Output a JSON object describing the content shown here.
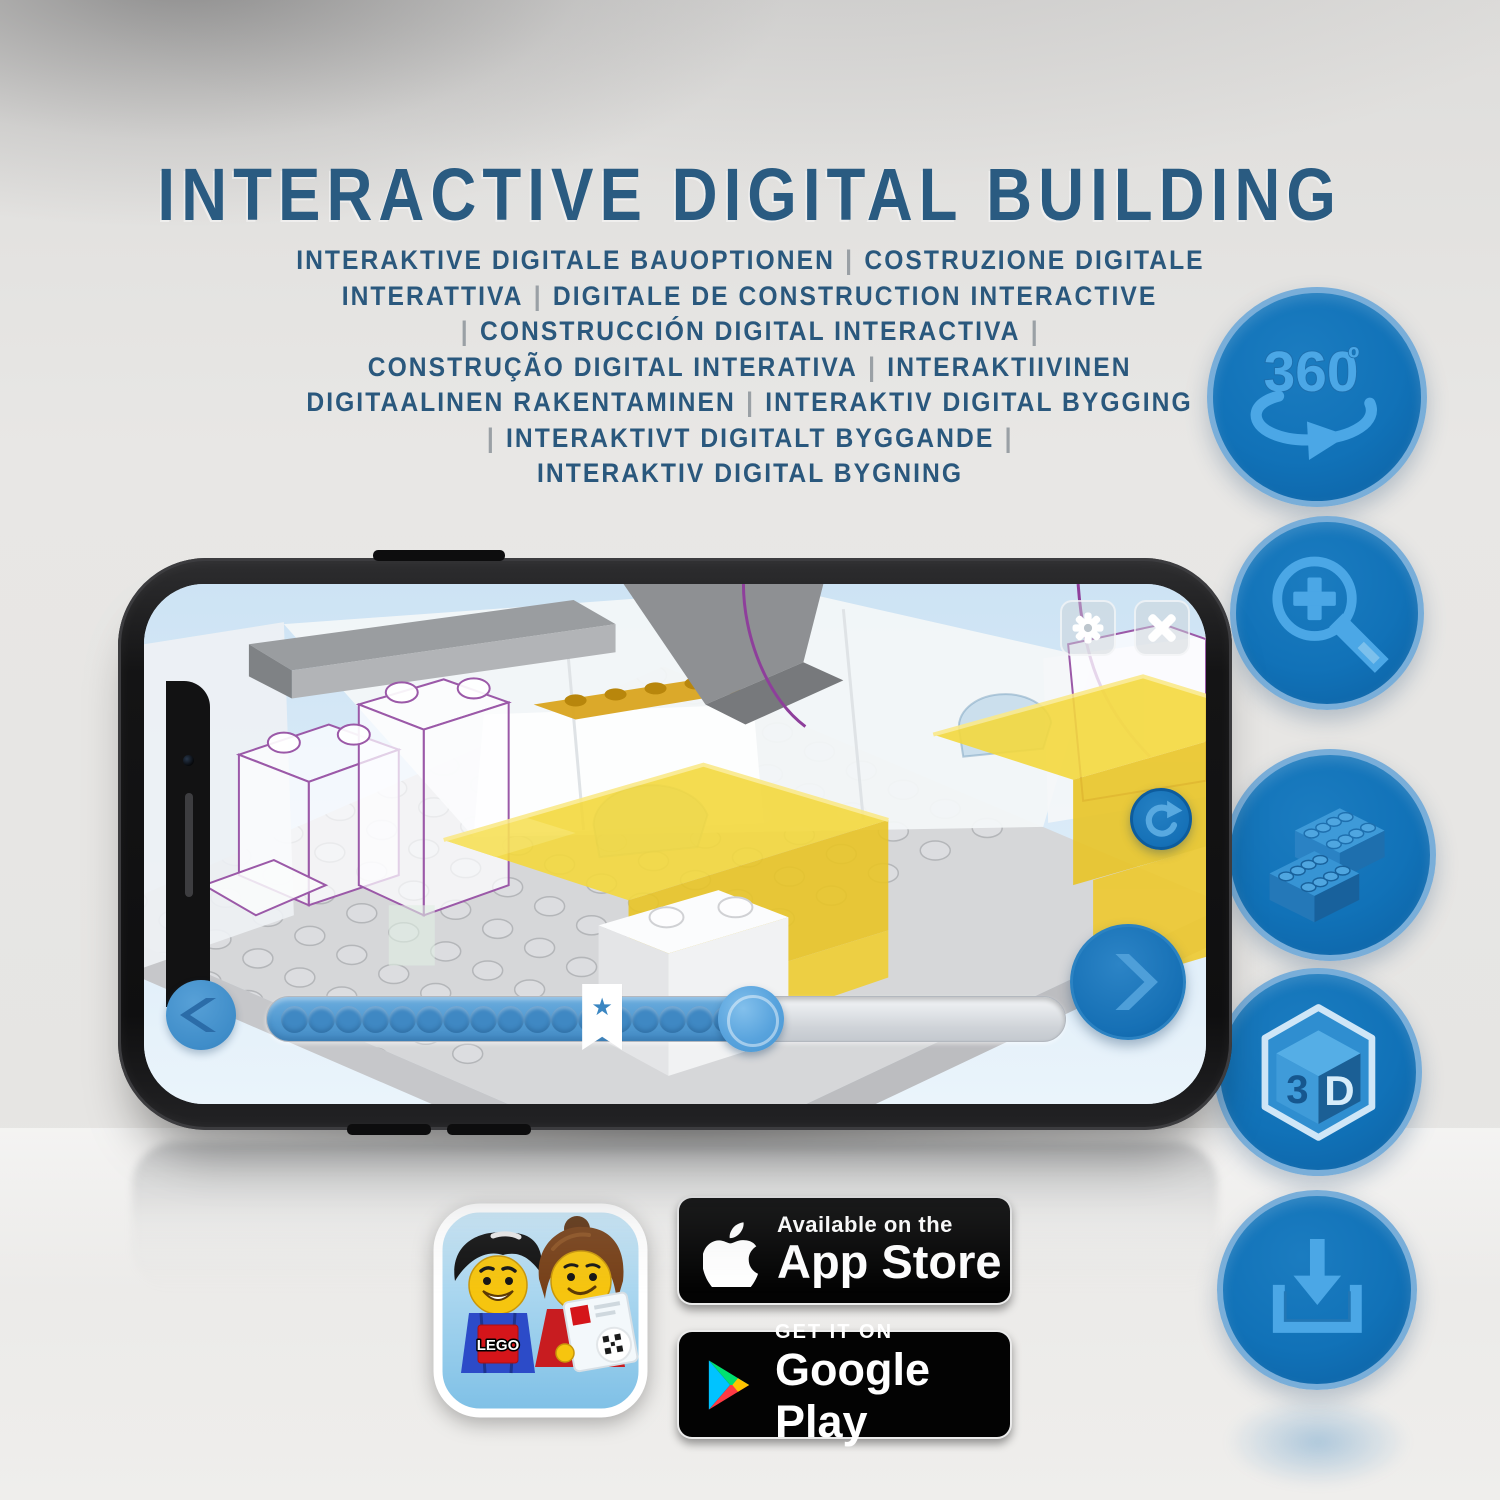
{
  "header": {
    "title": "INTERACTIVE DIGITAL BUILDING"
  },
  "subtitle": {
    "lines": [
      "INTERAKTIVE DIGITALE BAUOPTIONEN | COSTRUZIONE DIGITALE",
      "INTERATTIVA | DIGITALE DE CONSTRUCTION INTERACTIVE",
      "| CONSTRUCCIÓN DIGITAL INTERACTIVA |",
      "CONSTRUÇÃO DIGITAL INTERATIVA | INTERAKTIIVINEN",
      "DIGITAALINEN RAKENTAMINEN | INTERAKTIV DIGITAL BYGGING",
      "| INTERAKTIVT DIGITALT BYGGANDE |",
      "INTERAKTIV DIGITAL BYGNING"
    ]
  },
  "feature_rail": {
    "icons": [
      {
        "name": "rotate-360-icon",
        "label": "360",
        "degree": "º"
      },
      {
        "name": "zoom-in-icon",
        "label": ""
      },
      {
        "name": "brick-icon",
        "label": ""
      },
      {
        "name": "cube-3d-icon",
        "label_left": "3",
        "label_right": "D"
      },
      {
        "name": "download-icon",
        "label": ""
      }
    ]
  },
  "phone": {
    "screen": {
      "toolbar": {
        "settings_icon": "gear",
        "close_icon": "x"
      },
      "refresh_icon": "rotate-arrow",
      "progress": {
        "filled_pct": 61,
        "bookmark_pct": 42,
        "dot_count": 18,
        "bookmark_star": "★"
      },
      "nav": {
        "prev_icon": "chevron-left",
        "next_icon": "chevron-right"
      }
    }
  },
  "store": {
    "app_icon": {
      "logo_text": "LEGO"
    },
    "app_store_badge": {
      "line1": "Available on the",
      "line2": "App Store"
    },
    "google_play_badge": {
      "line1": "GET IT ON",
      "line2": "Google Play"
    }
  },
  "colors": {
    "title_blue": "#2a5b81",
    "rail_circle_blue": "#1172b8",
    "rail_icon_blue": "#4ba7e6",
    "brick_yellow": "#f2d435",
    "purple_outline": "#9b59a8",
    "separator_gray": "#9aa0a5"
  }
}
